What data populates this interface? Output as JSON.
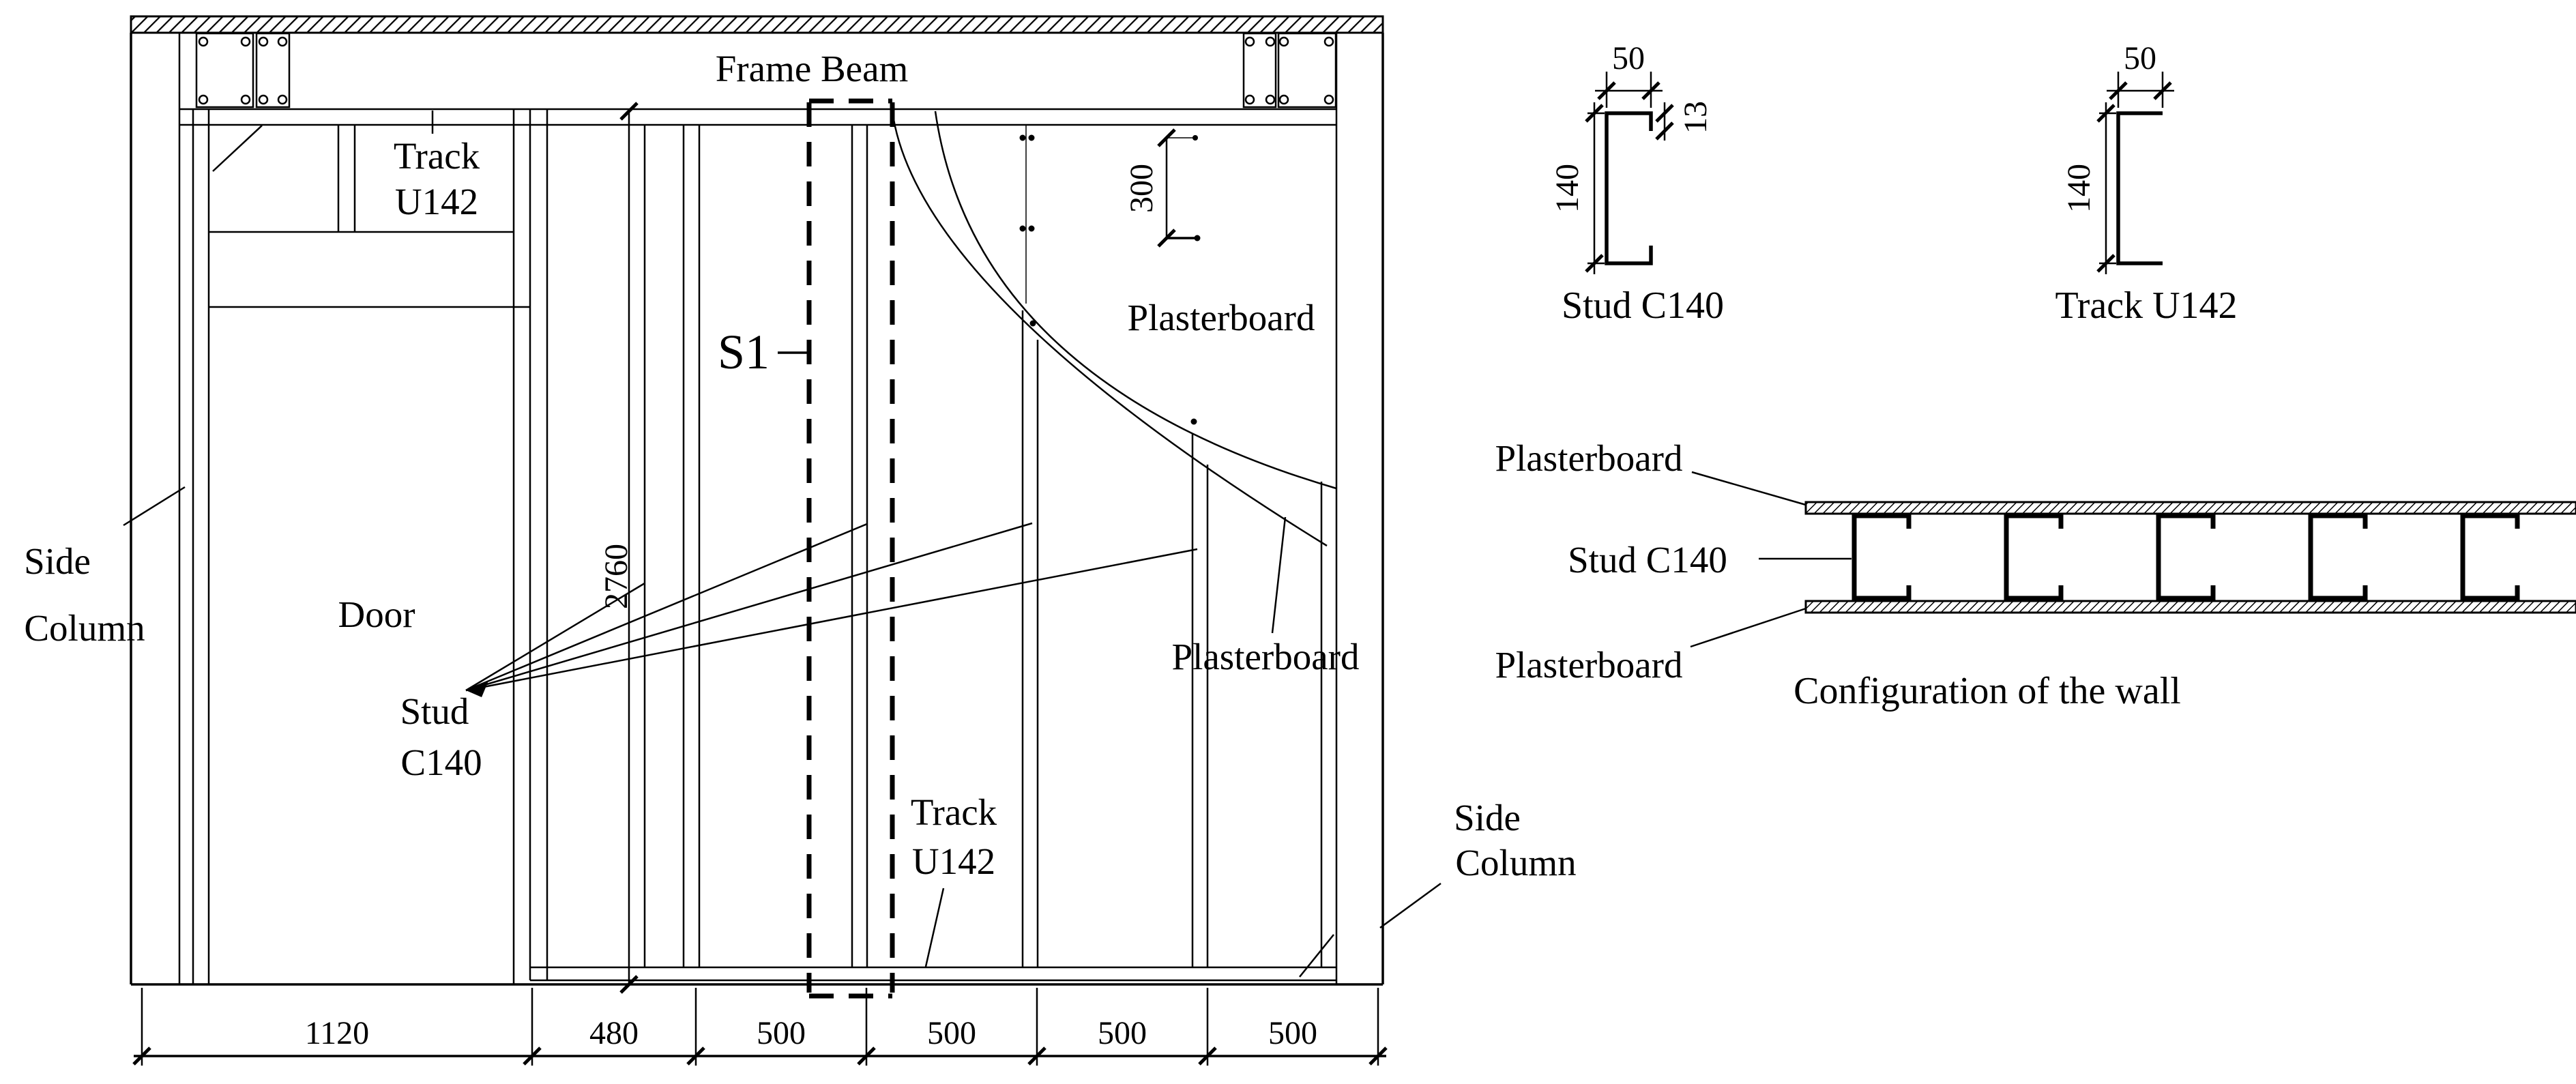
{
  "elevation": {
    "frame_beam": "Frame Beam",
    "track_top": [
      "Track",
      "U142"
    ],
    "side_column_left": [
      "Side",
      "Column"
    ],
    "door": "Door",
    "stud_c140": [
      "Stud",
      "C140"
    ],
    "section_marker": "S1",
    "plasterboard_upper": "Plasterboard",
    "plasterboard_lower": "Plasterboard",
    "track_bottom": [
      "Track",
      "U142"
    ],
    "side_column_right": [
      "Side",
      "Column"
    ],
    "height_dim": "2760",
    "screw_spacing_dim": "300",
    "bottom_dims": [
      "1120",
      "480",
      "500",
      "500",
      "500",
      "500"
    ]
  },
  "stud_section": {
    "width_dim": "50",
    "height_dim": "140",
    "lip_dim": "13",
    "caption": "Stud C140"
  },
  "track_section": {
    "width_dim": "50",
    "height_dim": "140",
    "caption": "Track U142"
  },
  "wall_configuration": {
    "plasterboard_top": "Plasterboard",
    "stud": "Stud C140",
    "plasterboard_bottom": "Plasterboard",
    "caption": "Configuration of the wall"
  }
}
